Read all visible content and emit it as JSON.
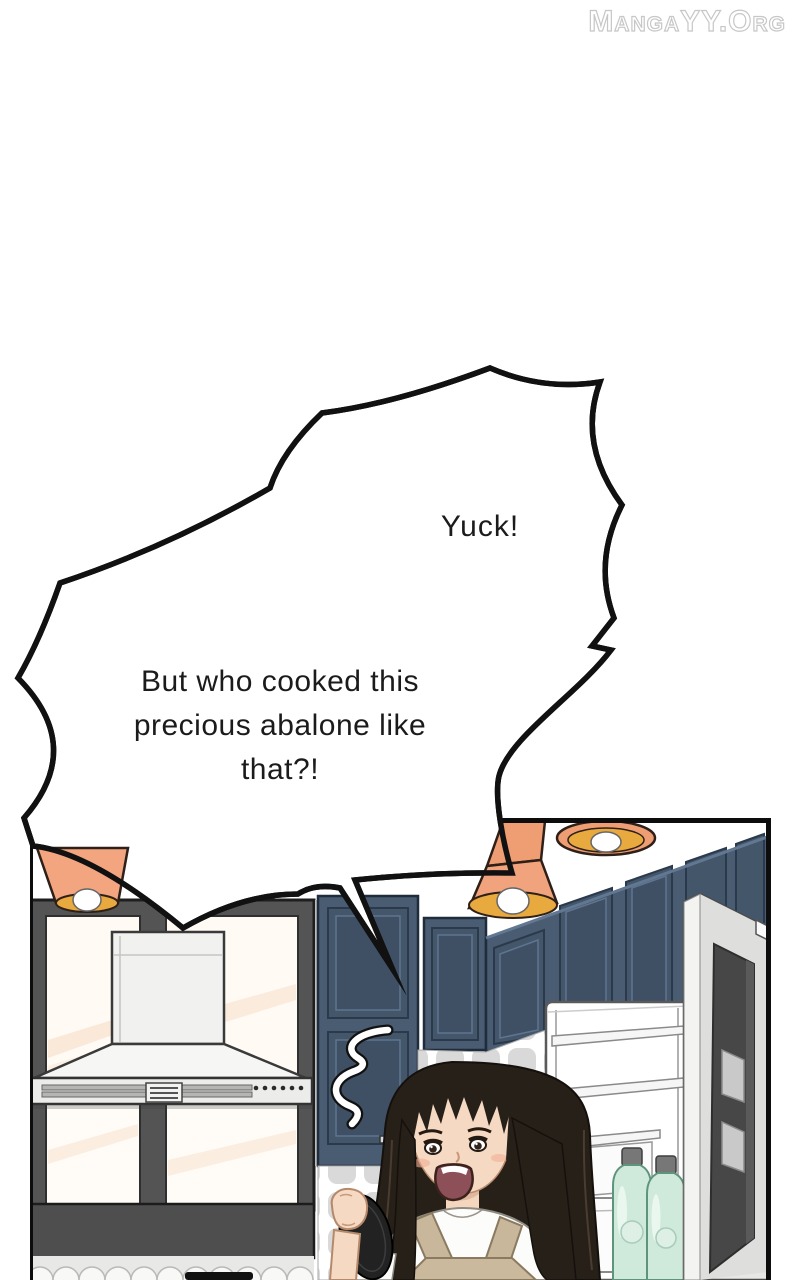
{
  "watermark": {
    "text": "MangaYY.Org",
    "color": "#ffffff",
    "outline_color": "#c7c7c7"
  },
  "speech_bubble": {
    "exclamation": "Yuck!",
    "lines": [
      "But who cooked this",
      "precious abalone like",
      "that?!"
    ],
    "fill": "#ffffff",
    "outline": "#111111"
  },
  "scene_colors": {
    "lamp_shade_orange": "#f0a37c",
    "lamp_inner_amber": "#e8a93e",
    "cabinet_blue": "#4a5c72",
    "window_frame_gray": "#545454",
    "pane_cream": "#fffaf4",
    "apron_tan": "#c9b79c",
    "hair_dark": "#262019",
    "skin": "#f6d9c2",
    "bottle_mint": "#cfe9db",
    "fridge_door_panel": "#474747",
    "tile_gray": "#d9d9d9"
  }
}
